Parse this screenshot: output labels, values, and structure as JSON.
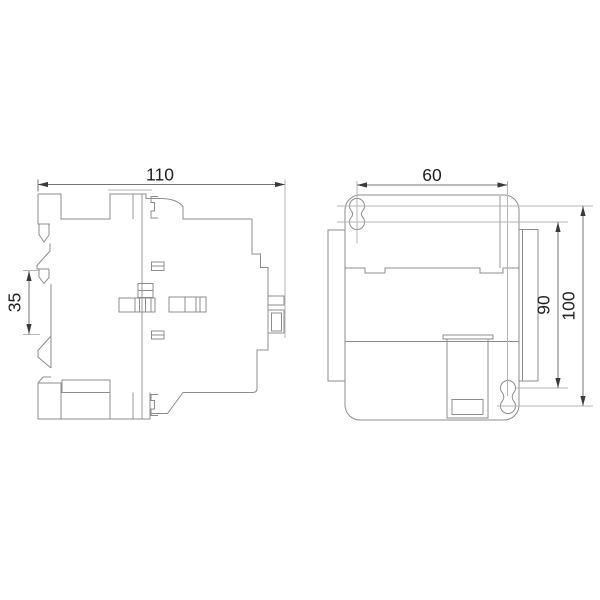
{
  "drawing": {
    "background": "#ffffff",
    "line_color": "#8c8c8c",
    "dim_line_color": "#757575",
    "arrow_color": "#3a3a3a",
    "text_color": "#1f1f1f",
    "views": [
      {
        "id": "side-view",
        "label": "side profile view with DIN-rail clip",
        "dimensions": [
          {
            "name": "overall-depth",
            "label": "110"
          },
          {
            "name": "din-rail-clip",
            "label": "35"
          }
        ]
      },
      {
        "id": "front-view",
        "label": "front view with keyhole mounting slots",
        "dimensions": [
          {
            "name": "mounting-hole-spacing",
            "label": "60"
          },
          {
            "name": "mounting-height",
            "label": "90"
          },
          {
            "name": "overall-height",
            "label": "100"
          }
        ]
      }
    ]
  }
}
